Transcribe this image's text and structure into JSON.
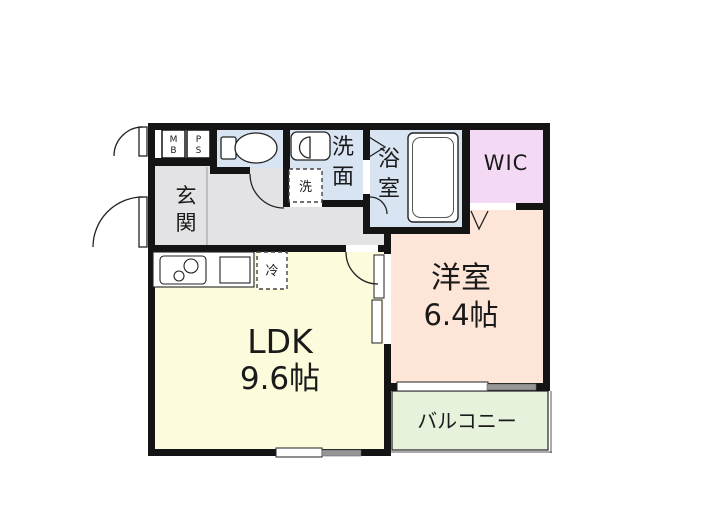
{
  "floorplan": {
    "rooms": {
      "genkan": {
        "name": "玄関",
        "chars": [
          "玄",
          "関"
        ]
      },
      "senmen": {
        "name": "洗面",
        "chars": [
          "洗",
          "面"
        ]
      },
      "bath": {
        "name": "浴室",
        "chars": [
          "浴",
          "室"
        ]
      },
      "wic": {
        "name": "WIC"
      },
      "western": {
        "name": "洋室",
        "size": "6.4帖"
      },
      "ldk": {
        "name": "LDK",
        "size": "9.6帖"
      },
      "balcony": {
        "name": "バルコニー"
      }
    },
    "fixtures": {
      "meter_box": {
        "chars": [
          "M",
          "B"
        ]
      },
      "pipe_space": {
        "chars": [
          "P",
          "S"
        ]
      },
      "washing_machine": {
        "label": "洗"
      },
      "refrigerator": {
        "label": "冷"
      }
    },
    "colors": {
      "wall": "#141414",
      "wet_area": "#d8e4f1",
      "wic": "#f4d9f4",
      "western_room": "#fde5d8",
      "ldk": "#fcfbdb",
      "balcony": "#e6f2dc",
      "hall": "#e3e3e5",
      "window_pane": "#969696",
      "outline": "#222222"
    }
  }
}
